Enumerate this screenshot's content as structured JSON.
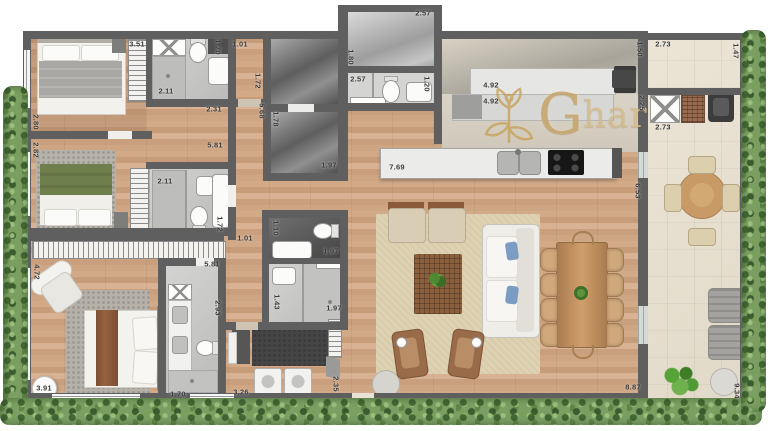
{
  "brand": {
    "initial": "G",
    "rest": "har"
  },
  "palette": {
    "wood": "#cda284",
    "wall": "#5f5f5f",
    "terrace": "#e8e1d3",
    "hedge": "#7b9f63",
    "gold": "#c6a468",
    "gray_room": "#8f8f8f",
    "bath_floor": "#c9c9c7",
    "bed_green": "#6f7f4c",
    "label": "#3a3a3a"
  },
  "dimension_labels": [
    {
      "text": "3.51",
      "x": 137,
      "y": 44,
      "rot": 0
    },
    {
      "text": "1.70",
      "x": 218,
      "y": 47,
      "rot": 90
    },
    {
      "text": "1.01",
      "x": 240,
      "y": 44,
      "rot": 0
    },
    {
      "text": "2.11",
      "x": 166,
      "y": 91,
      "rot": 0
    },
    {
      "text": "2.31",
      "x": 214,
      "y": 109,
      "rot": 0
    },
    {
      "text": "2.80",
      "x": 36,
      "y": 122,
      "rot": 90
    },
    {
      "text": "1.72",
      "x": 258,
      "y": 81,
      "rot": 90
    },
    {
      "text": "5.68",
      "x": 262,
      "y": 111,
      "rot": 90
    },
    {
      "text": "1.78",
      "x": 276,
      "y": 119,
      "rot": 90
    },
    {
      "text": "1.97",
      "x": 329,
      "y": 165,
      "rot": 0
    },
    {
      "text": "2.57",
      "x": 423,
      "y": 13,
      "rot": 0
    },
    {
      "text": "1.80",
      "x": 351,
      "y": 57,
      "rot": 90
    },
    {
      "text": "2.57",
      "x": 358,
      "y": 79,
      "rot": 0
    },
    {
      "text": "1.20",
      "x": 427,
      "y": 84,
      "rot": 90
    },
    {
      "text": "4.92",
      "x": 491,
      "y": 85,
      "rot": 0
    },
    {
      "text": "4.92",
      "x": 491,
      "y": 101,
      "rot": 0
    },
    {
      "text": "1.50",
      "x": 640,
      "y": 49,
      "rot": 90
    },
    {
      "text": "2.73",
      "x": 663,
      "y": 44,
      "rot": 0
    },
    {
      "text": "1.47",
      "x": 736,
      "y": 51,
      "rot": 90
    },
    {
      "text": "2.25",
      "x": 642,
      "y": 103,
      "rot": 90
    },
    {
      "text": "2.73",
      "x": 663,
      "y": 127,
      "rot": 0
    },
    {
      "text": "7.69",
      "x": 397,
      "y": 167,
      "rot": 0
    },
    {
      "text": "6.53",
      "x": 638,
      "y": 191,
      "rot": 90
    },
    {
      "text": "5.81",
      "x": 215,
      "y": 145,
      "rot": 0
    },
    {
      "text": "2.82",
      "x": 36,
      "y": 150,
      "rot": 90
    },
    {
      "text": "2.11",
      "x": 165,
      "y": 181,
      "rot": 0
    },
    {
      "text": "1.72",
      "x": 220,
      "y": 224,
      "rot": 90
    },
    {
      "text": "1.01",
      "x": 245,
      "y": 238,
      "rot": 0
    },
    {
      "text": "5.81",
      "x": 212,
      "y": 264,
      "rot": 0
    },
    {
      "text": "1.10",
      "x": 276,
      "y": 228,
      "rot": 90
    },
    {
      "text": "1.97",
      "x": 331,
      "y": 251,
      "rot": 0
    },
    {
      "text": "1.43",
      "x": 277,
      "y": 302,
      "rot": 90
    },
    {
      "text": "1.97",
      "x": 334,
      "y": 308,
      "rot": 0
    },
    {
      "text": "2.93",
      "x": 218,
      "y": 308,
      "rot": 90
    },
    {
      "text": "4.72",
      "x": 37,
      "y": 272,
      "rot": 90
    },
    {
      "text": "3.91",
      "x": 44,
      "y": 388,
      "rot": 0
    },
    {
      "text": "1.70",
      "x": 178,
      "y": 394,
      "rot": 0
    },
    {
      "text": "3.26",
      "x": 241,
      "y": 392,
      "rot": 0
    },
    {
      "text": "2.35",
      "x": 336,
      "y": 384,
      "rot": 90
    },
    {
      "text": "8.87",
      "x": 633,
      "y": 387,
      "rot": 0
    },
    {
      "text": "9.34",
      "x": 737,
      "y": 391,
      "rot": 90
    }
  ]
}
